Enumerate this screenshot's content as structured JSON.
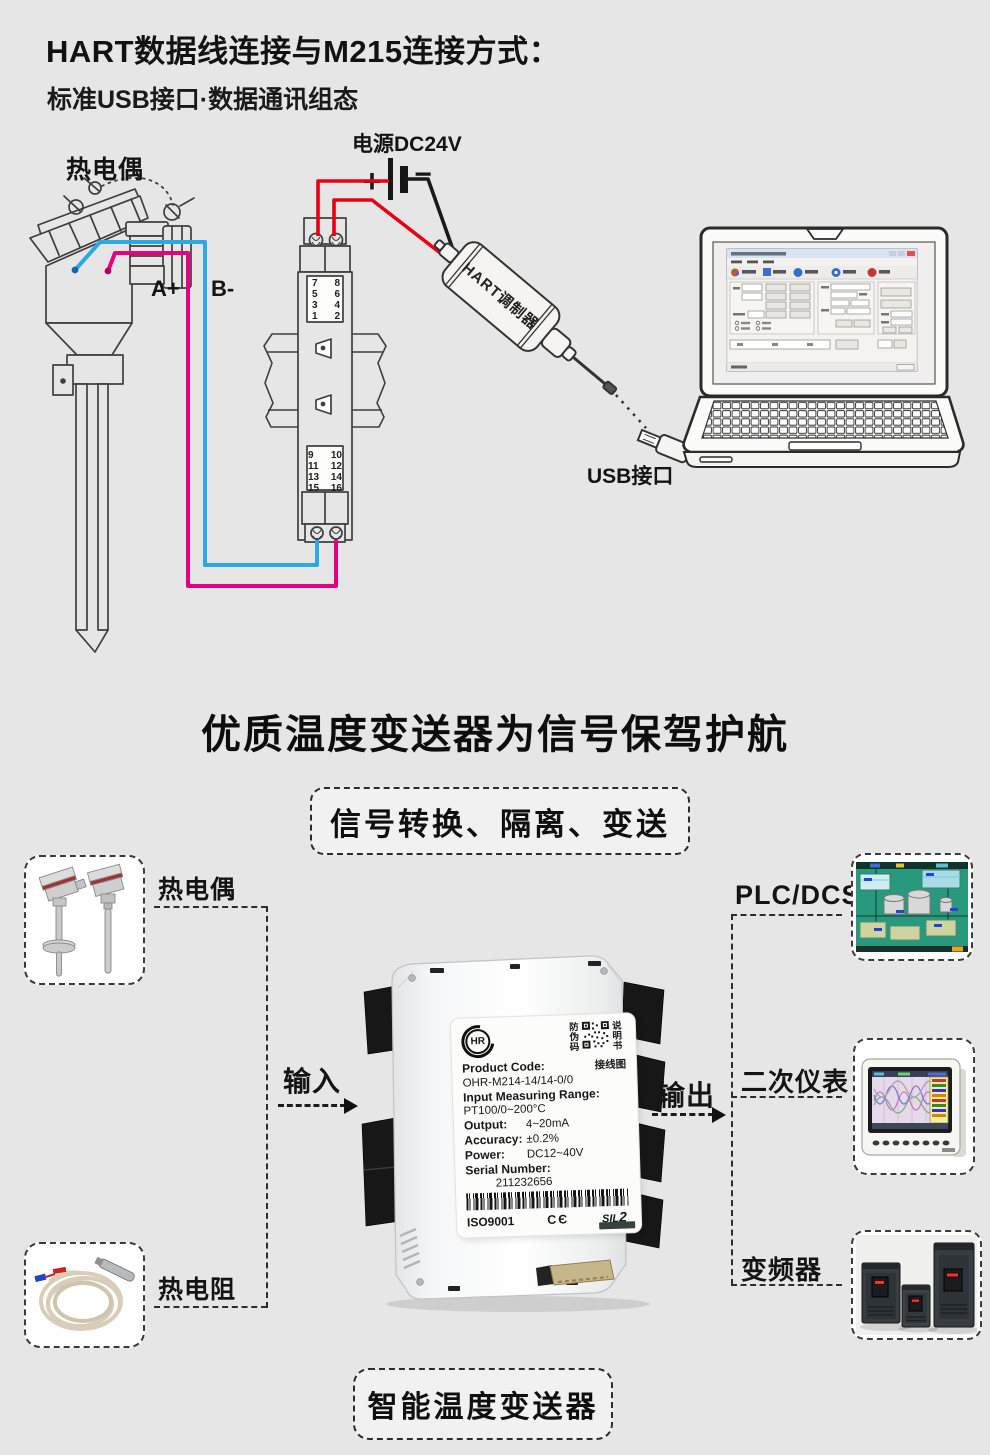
{
  "header": {
    "title": "HART数据线连接与M215连接方式：",
    "subtitle": "标准USB接口·数据通讯组态"
  },
  "wiring": {
    "thermocouple": "热电偶",
    "power": "电源DC24V",
    "plus": "+",
    "minus": "−",
    "wire_a": "A+",
    "wire_b": "B-",
    "hart_modem": "HART调制器",
    "usb_port": "USB接口",
    "top_left": [
      "7",
      "5",
      "3",
      "1"
    ],
    "top_right": [
      "8",
      "6",
      "4",
      "2"
    ],
    "bottom_left": [
      "9",
      "11",
      "13",
      "15"
    ],
    "bottom_right": [
      "10",
      "12",
      "14",
      "16"
    ]
  },
  "headline": "优质温度变送器为信号保驾护航",
  "feature_box": "信号转换、隔离、变送",
  "flow": {
    "input": "输入",
    "output": "输出",
    "source_thermocouple": "热电偶",
    "source_rtd": "热电阻",
    "dest_plc": "PLC/DCS",
    "dest_meter": "二次仪表",
    "dest_vfd": "变频器",
    "product": "智能温度变送器"
  },
  "label_card": {
    "brand": "HR",
    "anti_counterfeit": "防伪码",
    "manual": "说明书",
    "wiring_map": "接线图",
    "product_code_label": "Product Code:",
    "product_code": "OHR-M214-14/14-0/0",
    "range_label": "Input Measuring Range:",
    "range_value": "PT100/0~200°C",
    "output_label": "Output:",
    "output_value": "4~20mA",
    "accuracy_label": "Accuracy:",
    "accuracy_value": "±0.2%",
    "power_label": "Power:",
    "power_value": "DC12~40V",
    "serial_label": "Serial Number:",
    "serial_value": "211232656",
    "iso": "ISO9001",
    "ce": "CЄ",
    "sil": "SIL",
    "sil_level": "2"
  },
  "colors": {
    "background": "#e7e6e6",
    "line_dark": "#3f3f3f",
    "wire_red": "#e60012",
    "wire_blue": "#29abe2",
    "wire_magenta": "#e4007f",
    "scada_teal": "#28997d"
  }
}
